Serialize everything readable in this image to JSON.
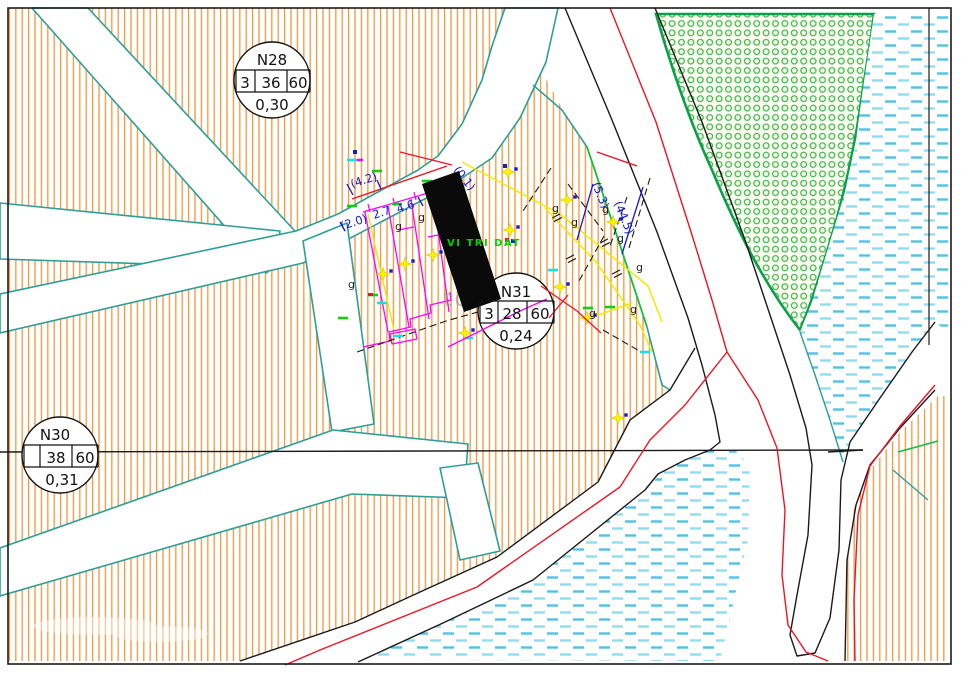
{
  "map_type": "cadastral-planning-drawing",
  "parcels": [
    {
      "name": "N28",
      "cells": [
        "3",
        "36",
        "60"
      ],
      "coefficient": "0,30"
    },
    {
      "name": "N30",
      "cells": [
        "",
        "38",
        "60"
      ],
      "coefficient": "0,31"
    },
    {
      "name": "N31",
      "cells": [
        "3",
        "28",
        "60"
      ],
      "coefficient": "0,24"
    }
  ],
  "site": {
    "label": "VI TRI DAT"
  },
  "dimensions": {
    "d42": "(4.2)",
    "d20": "(2.0)",
    "d27": "2.7",
    "d46": "4.6",
    "d01": "(0.1)",
    "d53": "(5.3)",
    "d445": "(44.5)"
  },
  "utility_letter": "g",
  "watermark": {
    "text": "tdo"
  },
  "colors": {
    "parcel_hatch": "#EC9A43",
    "parcel_boundary": "#2E9E96",
    "park_border": "#0AA04A",
    "park_dot": "#3FB34C",
    "water_dash": "#4EC3E6",
    "planning_red": "#EE1426",
    "road_edge_black": "#1A1A1A",
    "subdivision_magenta": "#FF00FF",
    "utility_yellow": "#F5E800",
    "dimension_blue": "#1414DD",
    "site_green": "#00D400",
    "subject_parcel": "#0A0A0A"
  },
  "symbols": {
    "stars": [
      [
        383,
        274
      ],
      [
        405,
        264
      ],
      [
        433,
        255
      ],
      [
        465,
        333
      ],
      [
        508,
        172
      ],
      [
        510,
        230
      ],
      [
        560,
        287
      ],
      [
        567,
        200
      ],
      [
        587,
        318
      ],
      [
        613,
        222
      ],
      [
        618,
        418
      ]
    ],
    "star_dots": [
      [
        391,
        271
      ],
      [
        413,
        261
      ],
      [
        441,
        252
      ],
      [
        473,
        330
      ],
      [
        516,
        169
      ],
      [
        518,
        227
      ],
      [
        568,
        284
      ],
      [
        575,
        197
      ],
      [
        595,
        315
      ],
      [
        621,
        219
      ],
      [
        626,
        415
      ]
    ],
    "g_positions": [
      [
        348,
        288
      ],
      [
        395,
        230
      ],
      [
        418,
        221
      ],
      [
        552,
        212
      ],
      [
        571,
        226
      ],
      [
        602,
        213
      ],
      [
        617,
        242
      ],
      [
        636,
        271
      ],
      [
        589,
        317
      ],
      [
        630,
        313
      ]
    ],
    "green_bars": [
      [
        343,
        318
      ],
      [
        373,
        295
      ],
      [
        588,
        308
      ],
      [
        610,
        307
      ],
      [
        352,
        206
      ],
      [
        397,
        204
      ],
      [
        427,
        181
      ],
      [
        377,
        171
      ]
    ],
    "cyan_bars": [
      [
        382,
        303
      ],
      [
        468,
        338
      ],
      [
        553,
        270
      ],
      [
        645,
        352
      ],
      [
        398,
        336
      ],
      [
        352,
        160
      ]
    ],
    "navy_dots": [
      [
        355,
        152
      ],
      [
        505,
        166
      ],
      [
        513,
        241
      ]
    ],
    "tick_pairs": [
      [
        556,
        216
      ],
      [
        570,
        257
      ],
      [
        604,
        241
      ],
      [
        616,
        272
      ]
    ]
  }
}
